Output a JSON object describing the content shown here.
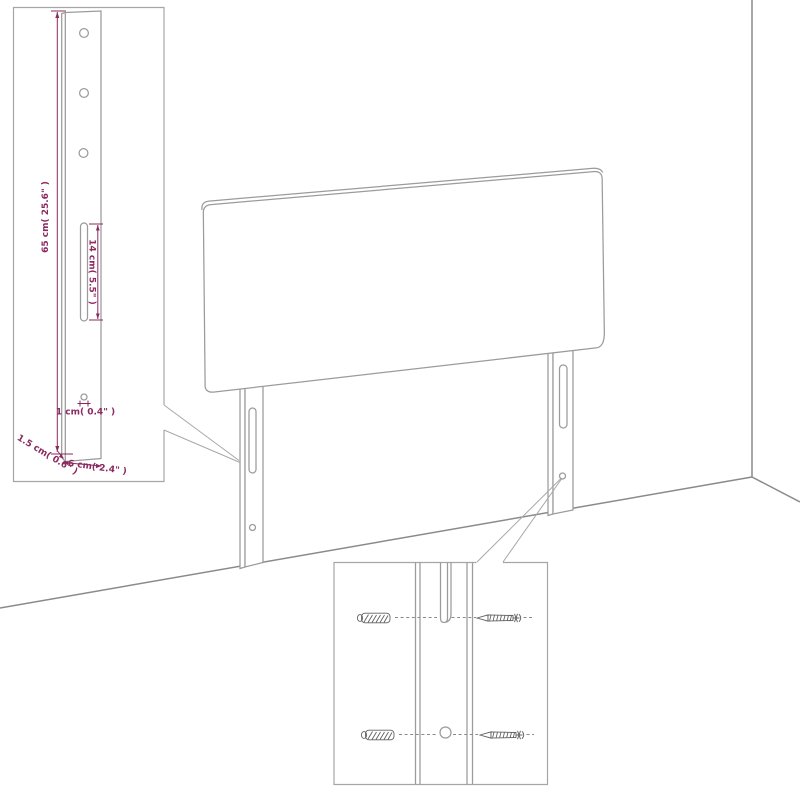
{
  "diagram": {
    "scene": "headboard-with-legs-against-wall-corner",
    "colors": {
      "background": "#ffffff",
      "line_gray": "#9b9b9b",
      "wall_gray": "#8a8a8a",
      "dimension_accent": "#8b2a60",
      "hardware_gray": "#616161"
    },
    "leg_detail_inset": {
      "dimensions": {
        "leg_height": "65 cm( 25.6\" )",
        "slot_length": "14 cm( 5.5\" )",
        "hole_diameter": "1 cm( 0.4\" )",
        "leg_thickness": "1.5 cm( 0.6\" )",
        "leg_width": "6 cm( 2.4\" )"
      }
    },
    "mounting_detail_inset": {
      "hardware_icons": [
        "wall-anchor-icon",
        "screw-icon",
        "wall-anchor-icon",
        "screw-icon"
      ]
    }
  }
}
